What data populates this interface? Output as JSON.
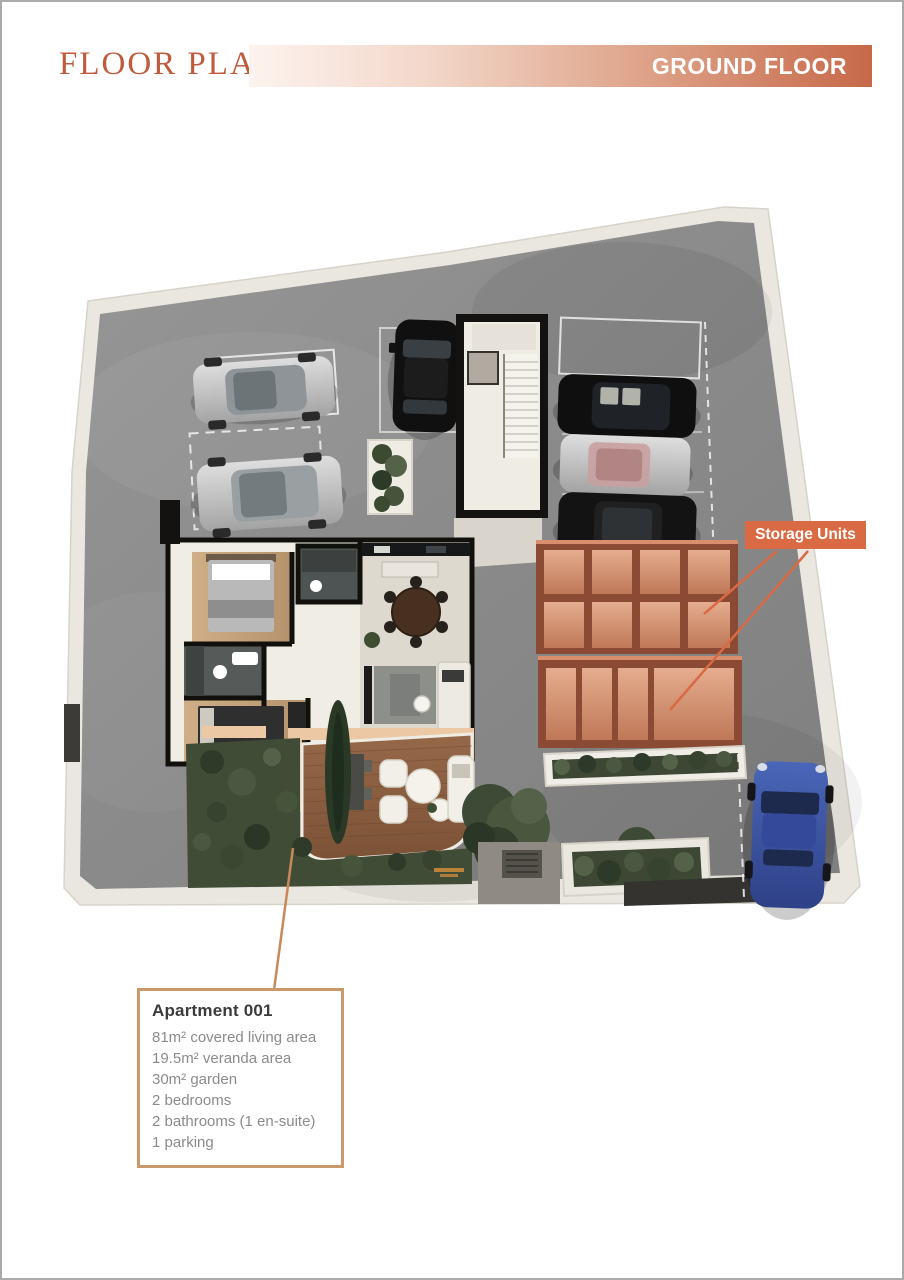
{
  "header": {
    "title": "FLOOR PLANS",
    "badge": "GROUND FLOOR"
  },
  "callout": {
    "storage": "Storage Units"
  },
  "apartment": {
    "title": "Apartment 001",
    "features": [
      "81m² covered living area",
      "19.5m² veranda area",
      "30m² garden",
      "2 bedrooms",
      "2 bathrooms (1 en-suite)",
      "1 parking"
    ]
  },
  "colors": {
    "accent_terracotta": "#bf5b3c",
    "header_gradient_end": "#c76949",
    "storage_label_bg": "#d96a44",
    "info_box_border": "#c9996b",
    "info_text_gray": "#8b8b8b",
    "concrete_gray": "#8d8d8d",
    "storage_wall_copper": "#8a4a33",
    "storage_floor_copper": "#d99c7d",
    "garden_green": "#414c37",
    "deck_wood": "#8a5f43",
    "sports_car_blue": "#3552a5"
  }
}
